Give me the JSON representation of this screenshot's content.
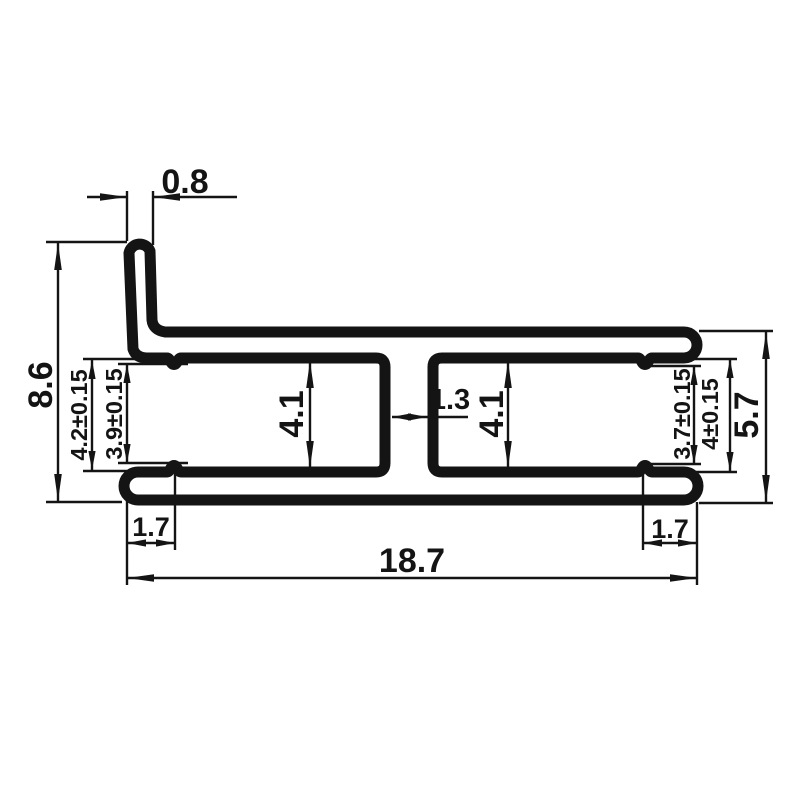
{
  "drawing": {
    "type": "technical-cross-section-profile",
    "units": "mm",
    "line_color": "#141414",
    "background_color": "#ffffff",
    "dims": {
      "flange_width": "0.8",
      "total_height": "8.6",
      "left_slot_entry_height": "4.2±0.15",
      "left_slot_inner_height": "3.9±0.15",
      "left_cavity_height": "4.1",
      "center_web_gap": "1.3",
      "right_cavity_height": "4.1",
      "right_slot_inner_height": "3.7±0.15",
      "right_slot_entry_height": "4±0.15",
      "body_height": "5.7",
      "left_ridge_inset": "1.7",
      "right_ridge_inset": "1.7",
      "total_width": "18.7"
    }
  }
}
